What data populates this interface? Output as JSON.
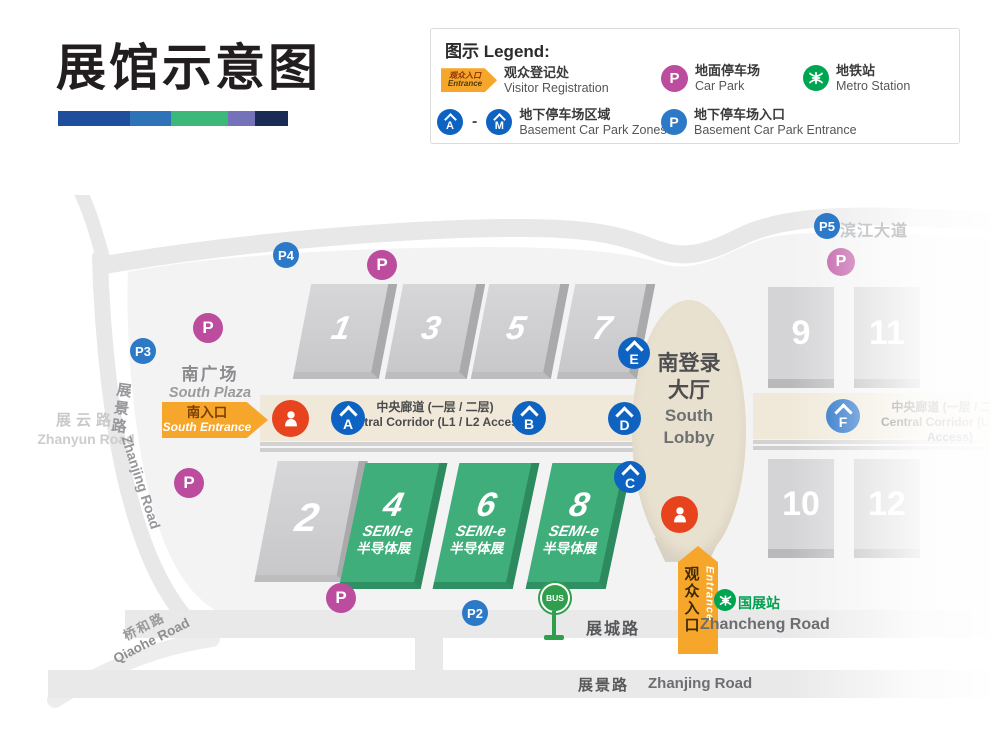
{
  "title": "展馆示意图",
  "deco": {
    "bar": [
      {
        "c": "#1f4e9c",
        "w": 72
      },
      {
        "c": "#2e72b8",
        "w": 41
      },
      {
        "c": "#3cb878",
        "w": 57
      },
      {
        "c": "#7472b8",
        "w": 27
      },
      {
        "c": "#1a2c56",
        "w": 33
      }
    ]
  },
  "legend": {
    "title": "图示 Legend:",
    "entrance_icon": {
      "line1": "观众入口",
      "line2": "Entrance"
    },
    "items": [
      {
        "zh": "观众登记处",
        "en": "Visitor Registration"
      },
      {
        "zh": "地面停车场",
        "en": "Car Park"
      },
      {
        "zh": "地铁站",
        "en": "Metro Station"
      },
      {
        "zh": "地下停车场区域",
        "en": "Basement Car Park Zones"
      },
      {
        "zh": "地下停车场入口",
        "en": "Basement Car Park Entrance"
      }
    ],
    "zone_from": "A",
    "zone_dash": "-",
    "zone_to": "M",
    "p_label": "P"
  },
  "map": {
    "roads": {
      "binjiang": "滨江大道",
      "zhanyun_zh": "展云路",
      "zhanyun_en": "Zhanyun Road",
      "zhanjing_left_zh": "展景路",
      "zhanjing_left_en": "Zhanjing Road",
      "qiaohe_zh": "桥和路",
      "qiaohe_en": "Qiaohe Road",
      "zhancheng_zh": "展城路",
      "zhancheng_en": "Zhancheng Road",
      "zhanjing_bottom_zh": "展景路",
      "zhanjing_bottom_en": "Zhanjing Road"
    },
    "areas": {
      "south_plaza_zh": "南广场",
      "south_plaza_en": "South Plaza",
      "lobby_zh1": "南登录",
      "lobby_zh2": "大厅",
      "lobby_en1": "South",
      "lobby_en2": "Lobby",
      "corridor_zh": "中央廊道 (一层 / 二层)",
      "corridor_en": "Central Corridor (L1 / L2 Access)"
    },
    "entrances": {
      "south_zh": "南入口",
      "south_en": "South Entrance",
      "visitor_zh": "观众入口",
      "visitor_en": "Entrance"
    },
    "halls_top": [
      "1",
      "3",
      "5",
      "7"
    ],
    "hall_2": "2",
    "halls_right": [
      "9",
      "11",
      "10",
      "12"
    ],
    "halls_green": [
      {
        "num": "4",
        "line1": "SEMI-e",
        "line2": "半导体展"
      },
      {
        "num": "6",
        "line1": "SEMI-e",
        "line2": "半导体展"
      },
      {
        "num": "8",
        "line1": "SEMI-e",
        "line2": "半导体展"
      }
    ],
    "parking_blue": [
      "P2",
      "P3",
      "P4",
      "P5"
    ],
    "p_pink_label": "P",
    "zone_badges": [
      "A",
      "B",
      "C",
      "D",
      "E",
      "F"
    ],
    "metro_station": "国展站",
    "bus_label": "BUS"
  }
}
